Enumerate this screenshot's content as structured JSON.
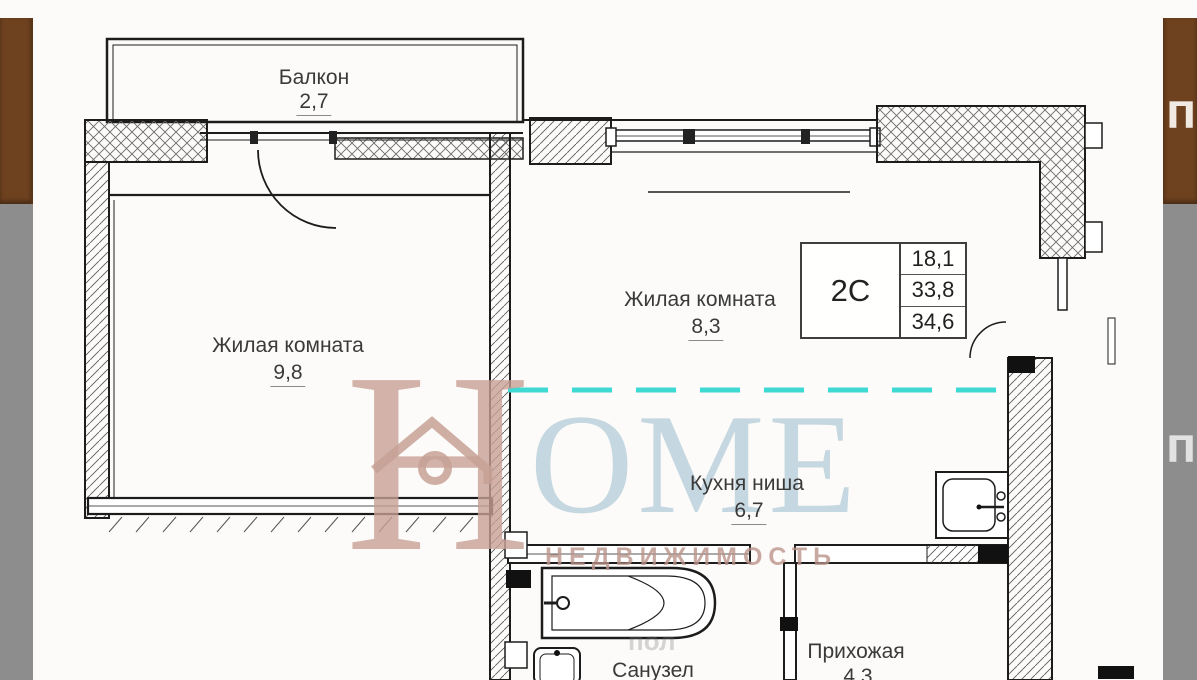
{
  "frame": {
    "left_strip": {
      "brown": "#6e421f",
      "gray": "#8d8d8d"
    },
    "right_strip": {
      "brown": "#6e421f",
      "gray": "#8d8d8d",
      "top_text_fragment": "по",
      "bottom_text_fragment": "по"
    }
  },
  "plan": {
    "balcony": {
      "name": "Балкон",
      "area": "2,7"
    },
    "living_room_left": {
      "name": "Жилая комната",
      "area": "9,8"
    },
    "living_room_right": {
      "name": "Жилая комната",
      "area": "8,3"
    },
    "kitchen_niche": {
      "name": "Кухня ниша",
      "area": "6,7"
    },
    "bathroom": {
      "name": "Санузел"
    },
    "hallway": {
      "name": "Прихожая",
      "area": "4,3"
    },
    "info_table": {
      "apartment_type": "2С",
      "living_area": "18,1",
      "apartment_area": "33,8",
      "total_area": "34,6"
    },
    "divider_color": "#3fd8d3"
  },
  "watermark": {
    "h": "H",
    "ome": "OME",
    "subtitle": "НЕДВИЖИМОСТЬ",
    "tile_fragment": "пол",
    "h_color": "#c7a095",
    "ome_color": "#a8c3d3"
  }
}
